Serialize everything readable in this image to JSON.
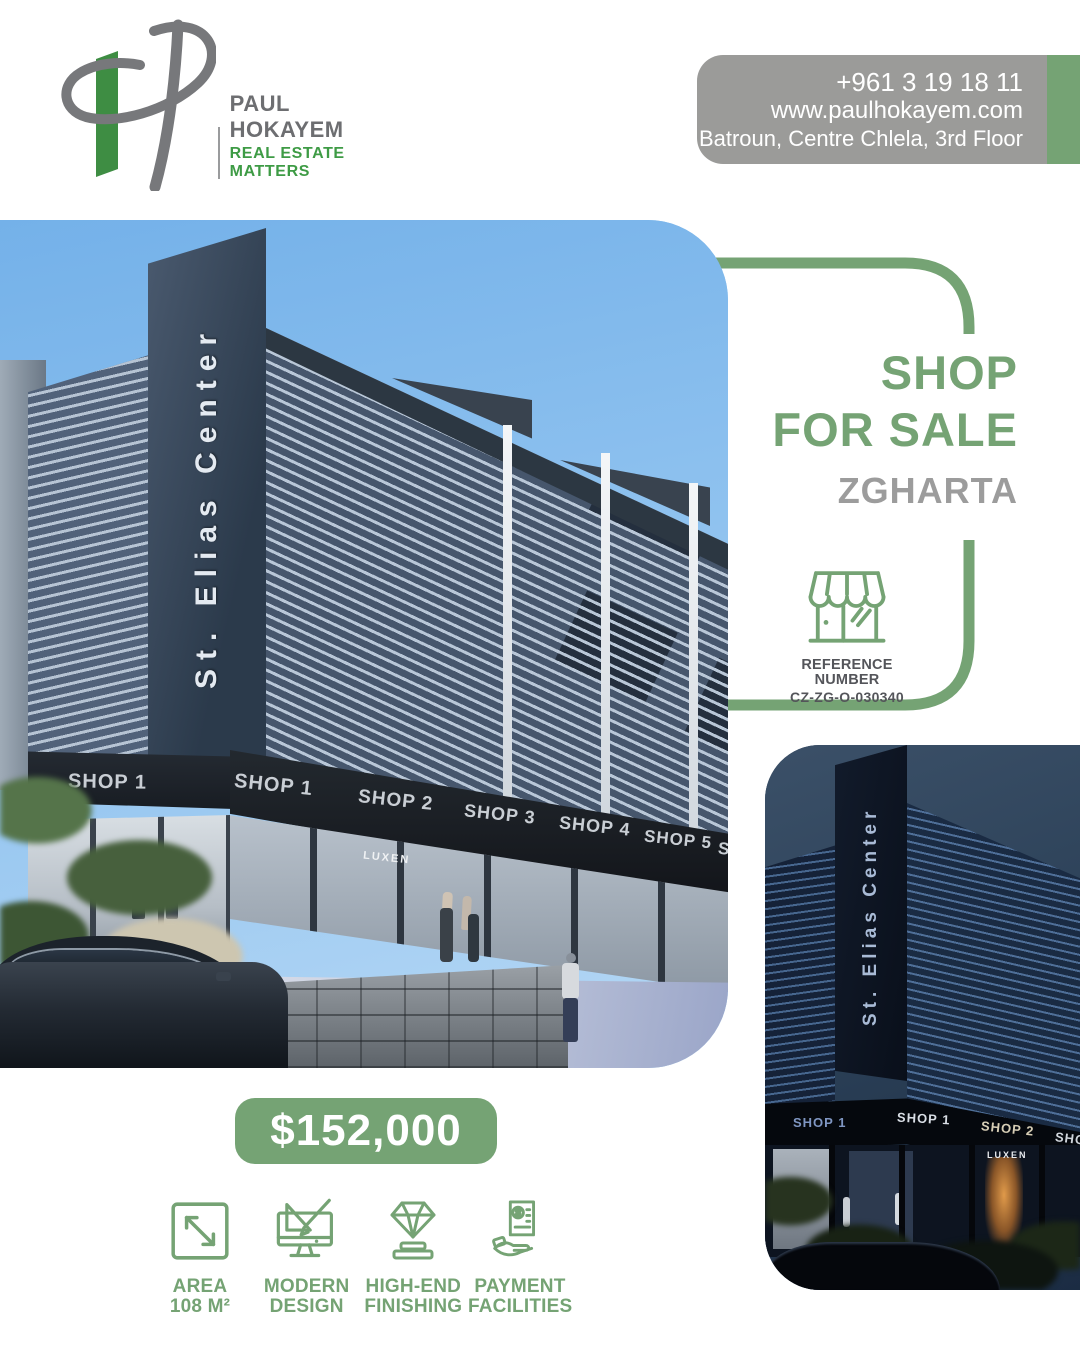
{
  "brand": {
    "name": "PAUL HOKAYEM",
    "tagline": "REAL ESTATE MATTERS",
    "colors": {
      "logo_green": "#3e9b45",
      "logo_gray": "#6d6e71"
    }
  },
  "contact": {
    "phone": "+961 3 19 18 11",
    "website": "www.paulhokayem.com",
    "address": "Batroun, Centre Chlela, 3rd Floor"
  },
  "listing": {
    "title_line1": "SHOP",
    "title_line2": "FOR SALE",
    "location": "ZGHARTA",
    "reference_label": "REFERENCE NUMBER",
    "reference_number": "CZ-ZG-O-030340",
    "price": "$152,000"
  },
  "features": [
    {
      "icon": "area-expand-icon",
      "line1": "AREA",
      "line2": "108 M²"
    },
    {
      "icon": "design-monitor-icon",
      "line1": "MODERN",
      "line2": "DESIGN"
    },
    {
      "icon": "diamond-icon",
      "line1": "HIGH-END",
      "line2": "FINISHING"
    },
    {
      "icon": "payment-hand-icon",
      "line1": "PAYMENT",
      "line2": "FACILITIES"
    }
  ],
  "photos": {
    "main": {
      "tower_sign": "St. Elias Center",
      "shop_signs": [
        "SHOP 1",
        "SHOP 1",
        "SHOP 2",
        "SHOP 3",
        "SHOP 4",
        "SHOP 5",
        "SH"
      ],
      "window_sign": "LUXEN"
    },
    "night": {
      "tower_sign": "St. Elias Center",
      "shop_signs": [
        "SHOP 1",
        "SHOP 1",
        "SHOP 2",
        "SHO"
      ],
      "window_sign": "LUXEN"
    }
  },
  "colors": {
    "accent_green": "#75a374",
    "banner_gray": "#9b9b99",
    "location_gray": "#9c9c9c",
    "reference_text": "#54555a"
  }
}
